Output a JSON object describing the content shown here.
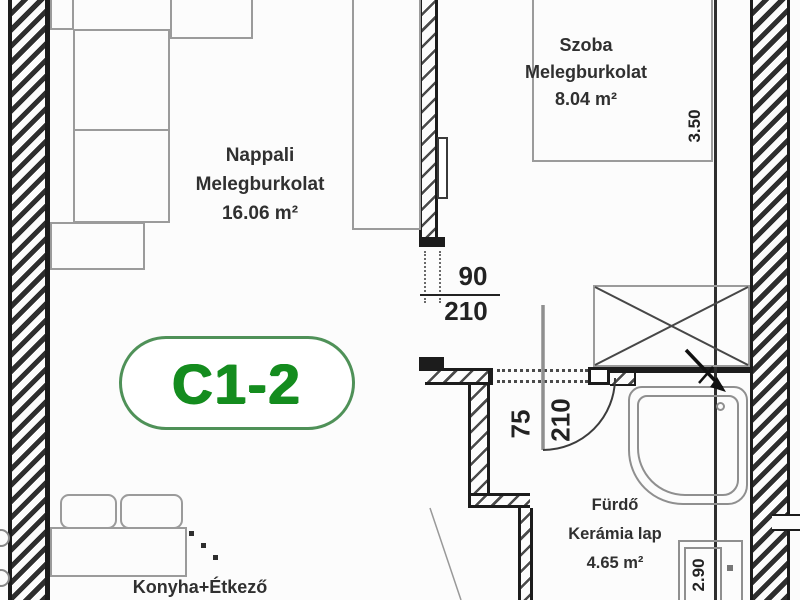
{
  "unit": {
    "label": "C1-2"
  },
  "rooms": {
    "nappali": {
      "name": "Nappali",
      "floor": "Melegburkolat",
      "area": "16.06 m²"
    },
    "szoba": {
      "name": "Szoba",
      "floor": "Melegburkolat",
      "area": "8.04 m²"
    },
    "furdo": {
      "name": "Fürdő",
      "floor": "Kerámia lap",
      "area": "4.65 m²"
    },
    "konyha": {
      "name": "Konyha+Étkező"
    }
  },
  "dimensions": {
    "szoba_door": {
      "width": "90",
      "height": "210"
    },
    "furdo_door": {
      "width": "75",
      "height": "210"
    },
    "szoba_length": "3.50",
    "furdo_length": "2.90"
  },
  "colors": {
    "badge_green": "#148c1e",
    "badge_outline": "#4f9158",
    "wall_ink": "#1c1c1c",
    "furniture_gray": "#9b9b9b"
  }
}
